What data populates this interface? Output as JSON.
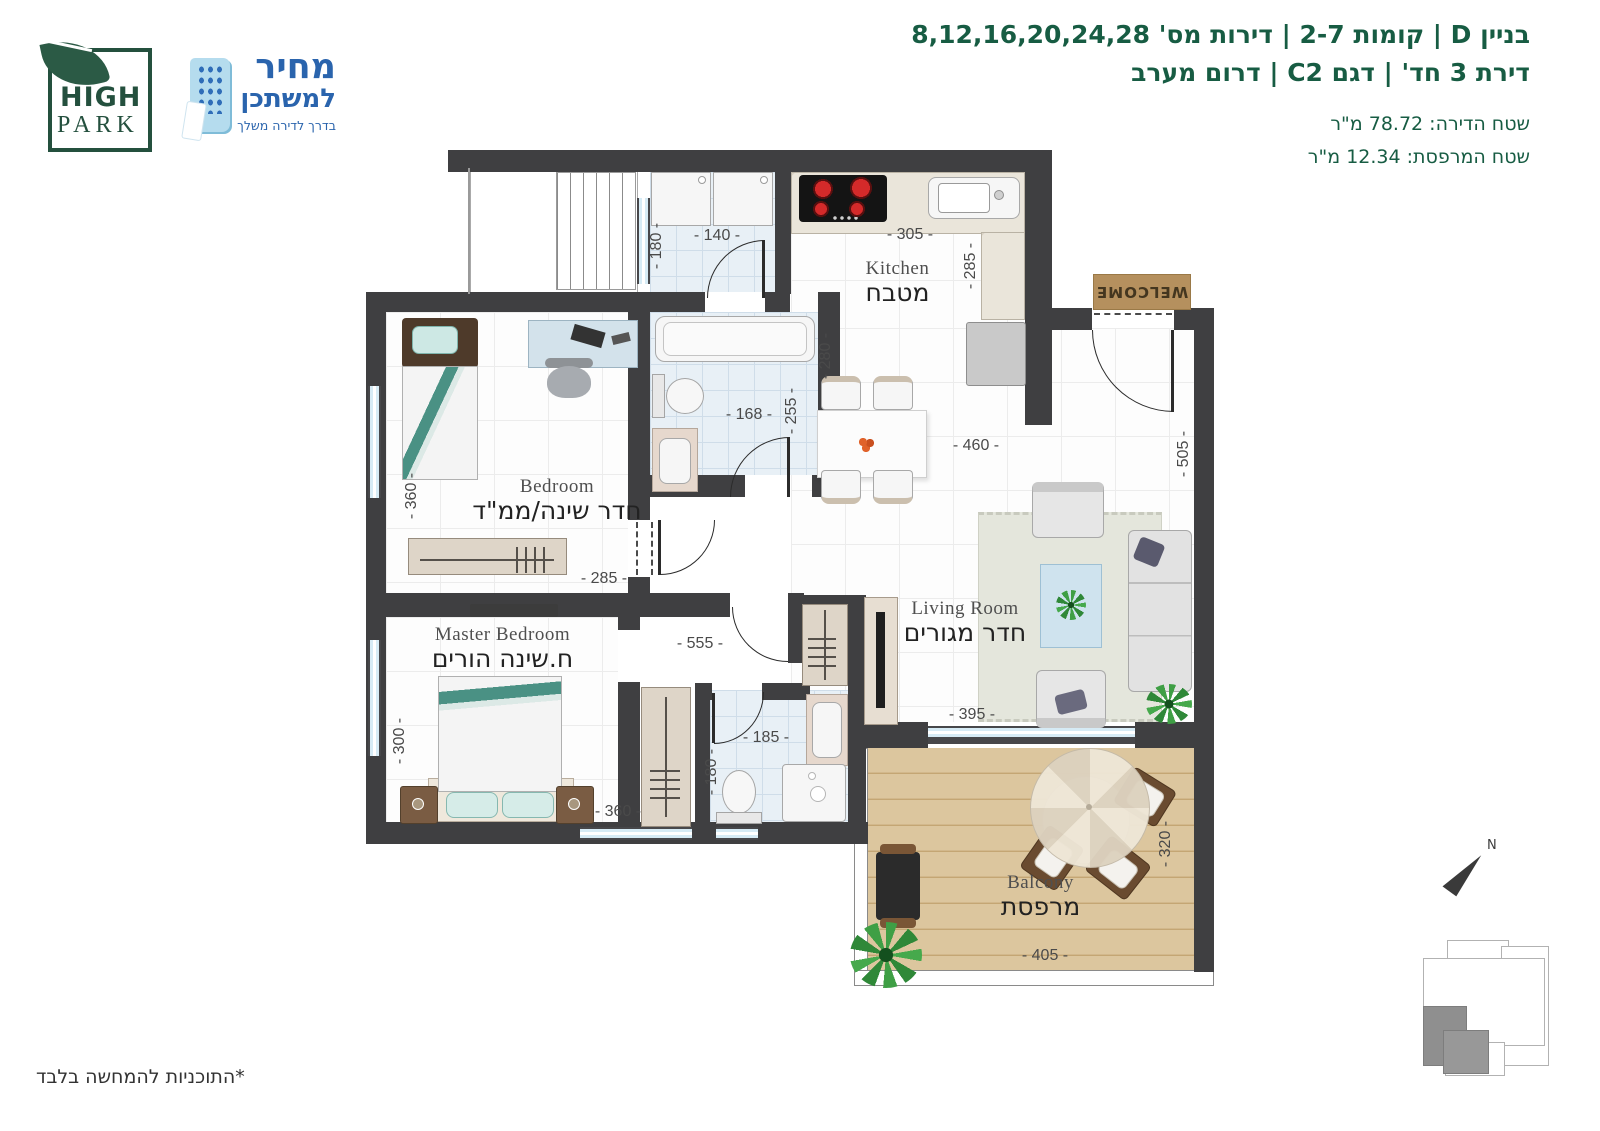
{
  "header": {
    "line1": "בניין D | קומות 2-7 | דירות מס' 8,12,16,20,24,28",
    "line2": "דירת 3 חד' | דגם C2 | דרום מערב",
    "apartment_area": "שטח הדירה: 78.72 מ\"ר",
    "balcony_area": "שטח המרפסת: 12.34 מ\"ר"
  },
  "logos": {
    "high_park": {
      "line1": "HIGH",
      "line2": "PARK"
    },
    "mechir_lamishtaken": {
      "line1": "מחיר",
      "line2": "למשתכן",
      "tagline": "בדרך לדירה משלך"
    }
  },
  "rooms": {
    "kitchen": {
      "en": "Kitchen",
      "he": "מטבח"
    },
    "bedroom": {
      "en": "Bedroom",
      "he": "חדר שינה/ממ\"ד"
    },
    "master": {
      "en": "Master Bedroom",
      "he": "ח.שינה הורים"
    },
    "living": {
      "en": "Living Room",
      "he": "חדר מגורים"
    },
    "balcony": {
      "en": "Balcony",
      "he": "מרפסת"
    }
  },
  "dims": {
    "laundry_depth": "- 180 -",
    "laundry_width": "- 140 -",
    "kitchen_width": "- 305 -",
    "kitchen_depth": "- 285 -",
    "dining_depth": "- 280 -",
    "dining_width": "- 460 -",
    "bath_width": "- 168 -",
    "bath_depth": "- 255 -",
    "bedroom_depth": "- 360 -",
    "bedroom_width": "- 285 -",
    "hall_width": "- 555 -",
    "master_depth": "- 300 -",
    "master_width": "- 360 -",
    "shower_width": "- 185 -",
    "shower_depth": "- 180 -",
    "living_width": "- 395 -",
    "living_depth": "- 505 -",
    "balcony_depth": "- 320 -",
    "balcony_width": "- 405 -"
  },
  "annotations": {
    "welcome_mat": "WELCOME",
    "north": "N",
    "disclaimer": "*התוכניות להמחשה בלבד"
  },
  "colors": {
    "wall": "#3f3f41",
    "brand_green": "#175c43",
    "brand_blue": "#2a64ad",
    "tile": "#e8f0f6",
    "wood": "#dcc69e",
    "marble": "#eae5da",
    "mat": "#b5905e"
  }
}
